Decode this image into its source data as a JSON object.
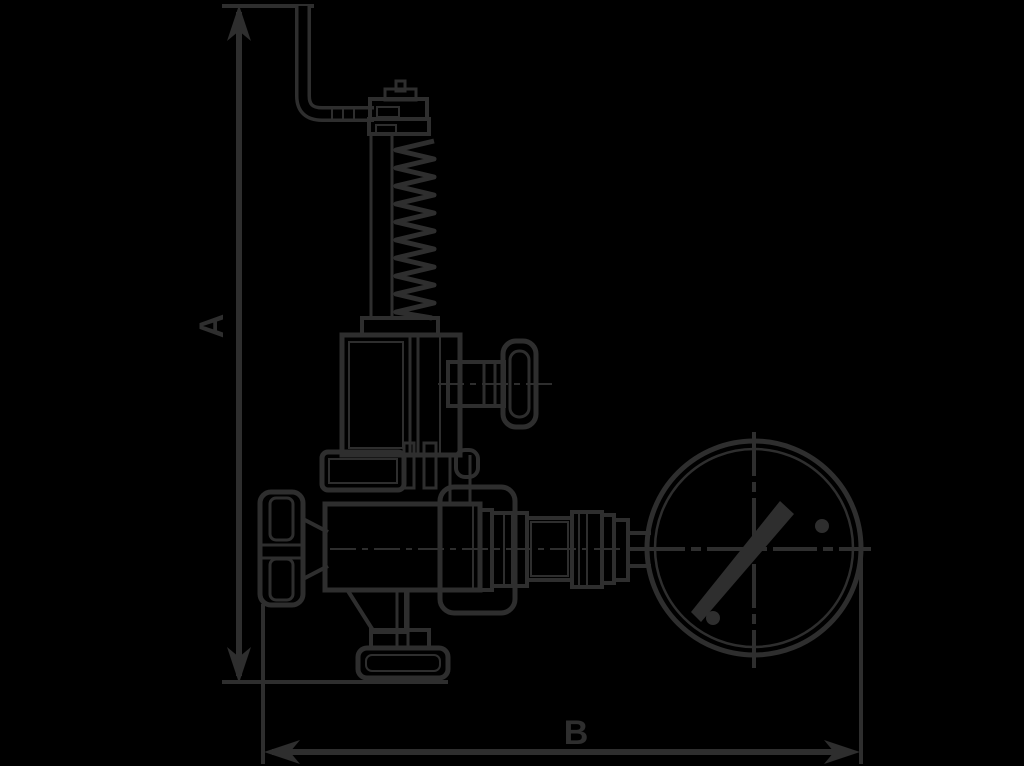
{
  "diagram": {
    "kind": "technical-line-drawing",
    "subject": "spring-loaded safety relief valve with lifting lever, hand wheels and pressure gauge",
    "background_color": "#000000",
    "line_color": "#2e2e2e",
    "dimensions": {
      "height": {
        "label": "A",
        "orientation": "vertical"
      },
      "width": {
        "label": "B",
        "orientation": "horizontal"
      }
    },
    "parts": [
      "lifting-lever",
      "adjusting-screw",
      "spring",
      "spindle",
      "bonnet",
      "gland-hand-wheel",
      "inlet-flange",
      "valve-body",
      "side-hand-wheel",
      "outlet-taper",
      "base-flange",
      "gauge-piping",
      "pressure-gauge",
      "gauge-needle"
    ]
  }
}
